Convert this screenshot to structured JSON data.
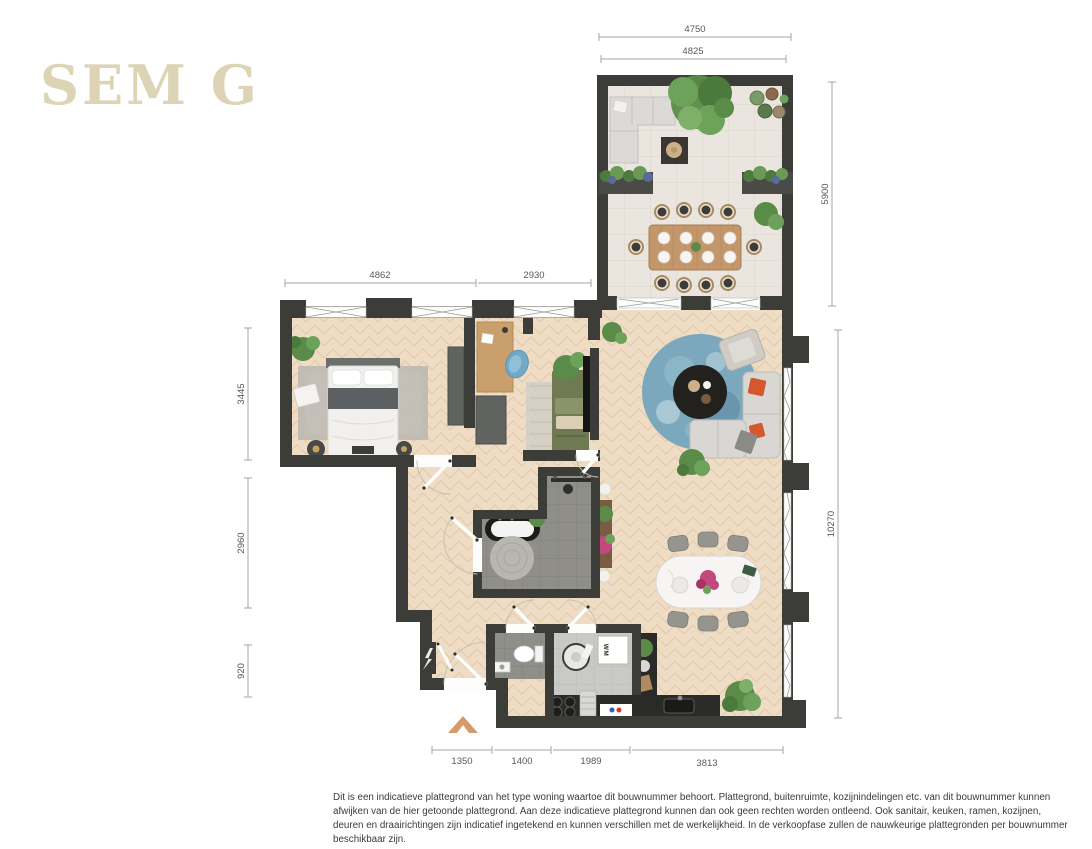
{
  "logo": {
    "text": "SEM G"
  },
  "plan": {
    "dimensions": {
      "terrace_width_outer": "4750",
      "terrace_width_inner": "4825",
      "terrace_height": "5900",
      "top_left_width": "4862",
      "top_right_width": "2930",
      "left_upper": "3445",
      "left_middle": "2960",
      "left_lower": "920",
      "right_height": "10270",
      "bottom_1": "1350",
      "bottom_2": "1400",
      "bottom_3": "1989",
      "bottom_4": "3813"
    },
    "labels": {
      "washing_machine": "WM"
    },
    "icons": {
      "meter_cupboard": "lightning-bolt",
      "entrance": "chevron-up-arrow"
    }
  },
  "disclaimer": {
    "text": "Dit is een indicatieve plattegrond van het type woning waartoe dit bouwnummer behoort. Plattegrond, buitenruimte, kozijnindelingen etc. van dit bouwnummer kunnen afwijken van de hier getoonde plattegrond. Aan deze indicatieve plattegrond kunnen dan ook geen rechten worden ontleend. Ook sanitair, keuken, ramen, kozijnen, deuren en draairichtingen zijn indicatief ingetekend en kunnen verschillen met de werkelijkheid. In de verkoopfase zullen de nauwkeurige plattegronden per bouwnummer beschikbaar zijn."
  },
  "colors": {
    "wall": "#3c3c39",
    "wood_floor": "#eedcc4",
    "terrace_tile": "#eae6df",
    "bath_tile": "#8f8e89",
    "accent_orange": "#d79a6b",
    "logo_beige": "#ddd3b5",
    "sofa_orange": "#d4572e",
    "rug_blue": "#7ba8bc"
  }
}
